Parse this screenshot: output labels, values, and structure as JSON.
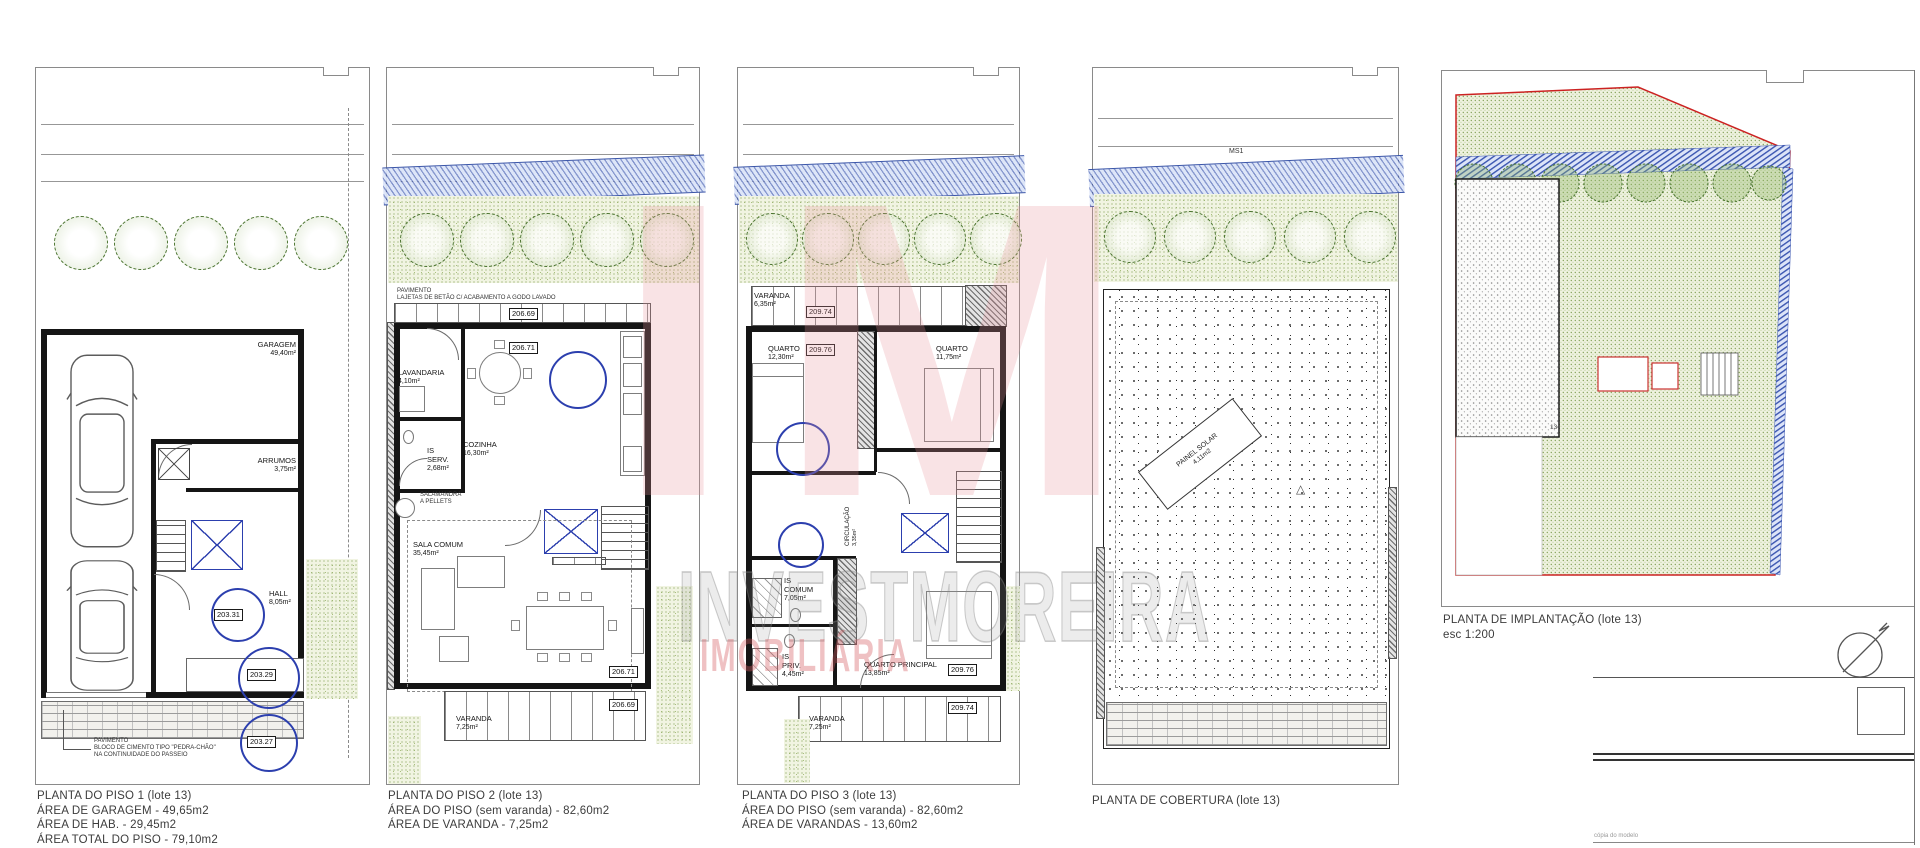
{
  "watermark": {
    "brand": "IM",
    "name": "INVESTMOREIRA",
    "tagline": "IMOBILIÁRIA"
  },
  "p1": {
    "cap1": "PLANTA DO PISO 1 (lote 13)",
    "cap2": "ÁREA DE GARAGEM - 49,65m2",
    "cap3": "ÁREA DE HAB. - 29,45m2",
    "cap4": "ÁREA TOTAL DO PISO - 79,10m2",
    "garagem": "GARAGEM",
    "garagem_area": "49,40m²",
    "arrumos": "ARRUMOS",
    "arrumos_area": "3,75m²",
    "hall": "HALL",
    "hall_area": "8,05m²",
    "lvl_hall": "203.31",
    "lvl_entrada": "203.29",
    "lvl_passeio": "203.27",
    "note1": "PAVIMENTO",
    "note2": "BLOCO DE CIMENTO TIPO \"PEDRA-CHÃO\"",
    "note3": "NA CONTINUIDADE DO PASSEIO"
  },
  "p2": {
    "cap1": "PLANTA DO PISO 2 (lote 13)",
    "cap2": "ÁREA DO PISO (sem varanda) - 82,60m2",
    "cap3": "ÁREA DE VARANDA - 7,25m2",
    "note1": "PAVIMENTO",
    "note2": "LAJETAS DE BETÃO C/ ACABAMENTO A GODO LAVADO",
    "lvl_terraco": "206.69",
    "lvl_piso_a": "206.71",
    "lvl_piso_b": "206.71",
    "lvl_varanda": "206.69",
    "lavandaria": "LAVANDARIA",
    "lavandaria_area": "4,10m²",
    "is1": "IS",
    "serv": "SERV.",
    "serv_area": "2,68m²",
    "cozinha": "COZINHA",
    "cozinha_area": "16,30m²",
    "sala": "SALA COMUM",
    "sala_area": "35,45m²",
    "varanda": "VARANDA",
    "varanda_area": "7,25m²",
    "salamandra1": "SALAMANDRA",
    "salamandra2": "A PELLETS"
  },
  "p3": {
    "cap1": "PLANTA DO PISO 3 (lote 13)",
    "cap2": "ÁREA DO PISO (sem varanda) - 82,60m2",
    "cap3": "ÁREA DE VARANDAS - 13,60m2",
    "varanda1": "VARANDA",
    "varanda1_area": "6,35m²",
    "lvl_var1": "209.74",
    "quarto1": "QUARTO",
    "quarto1_area": "12,30m²",
    "lvl_quarto1": "209.76",
    "quarto2": "QUARTO",
    "quarto2_area": "11,75m²",
    "circ": "CIRCULAÇÃO",
    "circ_area": "3,35m²",
    "is_comum1": "IS",
    "is_comum2": "COMUM",
    "is_comum_area": "7,05m²",
    "is_priv1": "IS",
    "is_priv2": "PRIV.",
    "is_priv_area": "4,45m²",
    "qp": "QUARTO PRINCIPAL",
    "qp_area": "13,85m²",
    "lvl_qp": "209.76",
    "varanda2": "VARANDA",
    "varanda2_area": "7,25m²",
    "lvl_var2": "209.74"
  },
  "p4": {
    "cap1": "PLANTA DE COBERTURA (lote 13)",
    "ms1": "MS1",
    "solar1": "PAINEL SOLAR",
    "solar2": "4,11m2"
  },
  "p5": {
    "cap1": "PLANTA DE IMPLANTAÇÃO (lote 13)",
    "cap2": "esc 1:200",
    "plot": "13",
    "footer": "cópia do modelo"
  }
}
